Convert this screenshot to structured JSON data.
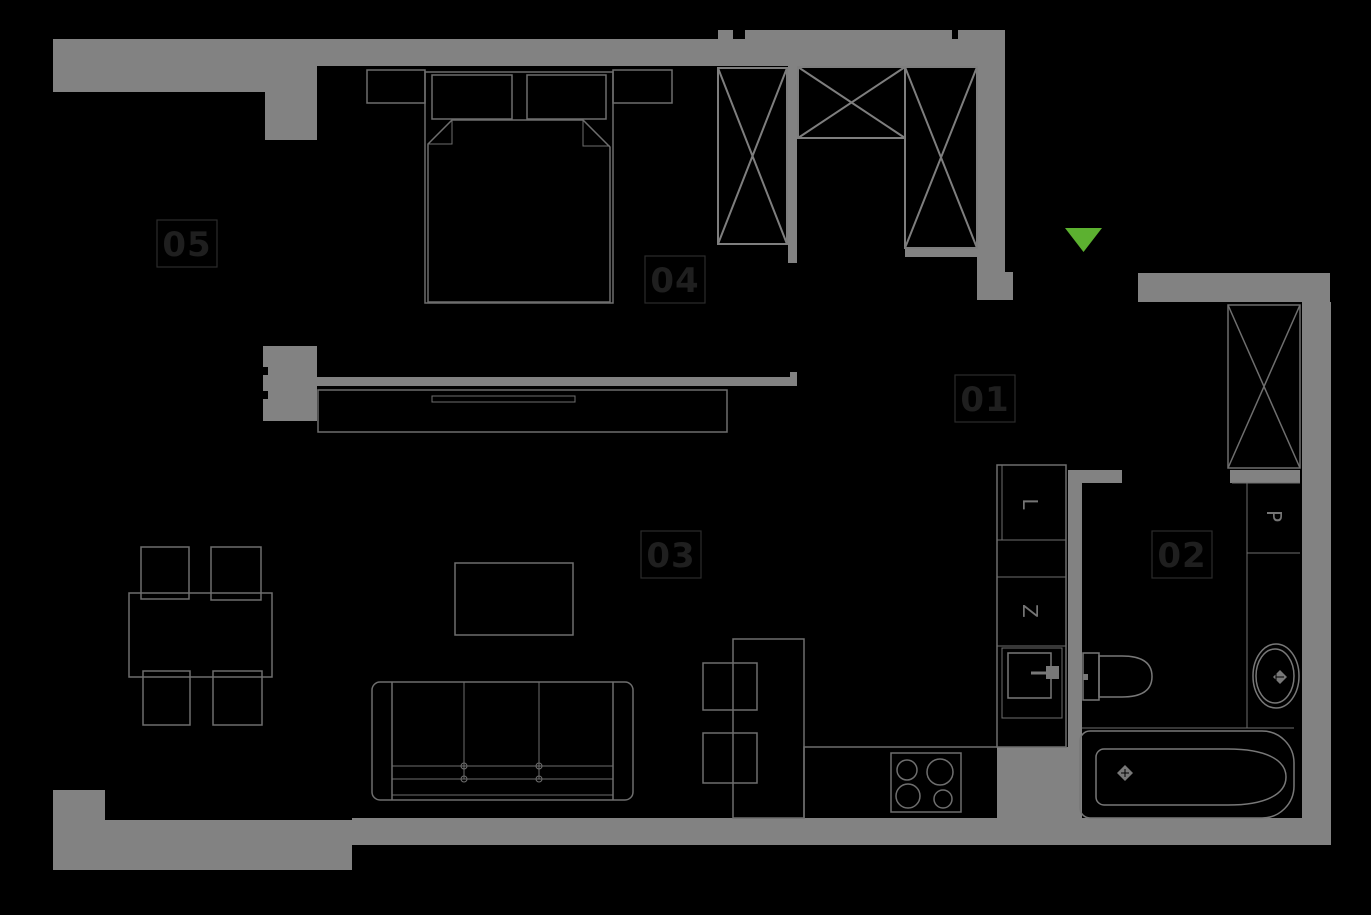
{
  "floorplan": {
    "background_color": "#000000",
    "wall_color": "#828282",
    "furniture_line_color": "#6e6e6e",
    "wardrobe_line_color": "#7e7e7e",
    "fixture_line_color": "#787878",
    "label_text_color": "#1f1f1f",
    "label_border_color": "#2b2b2b",
    "appliance_letter_color": "#757575",
    "entrance_marker_color": "#5cb130",
    "rooms": {
      "hall": "01",
      "bathroom": "02",
      "living_room": "03",
      "bedroom": "04",
      "balcony": "05"
    },
    "appliances": {
      "fridge": "L",
      "dishwasher": "Z",
      "washing_machine": "P"
    }
  }
}
